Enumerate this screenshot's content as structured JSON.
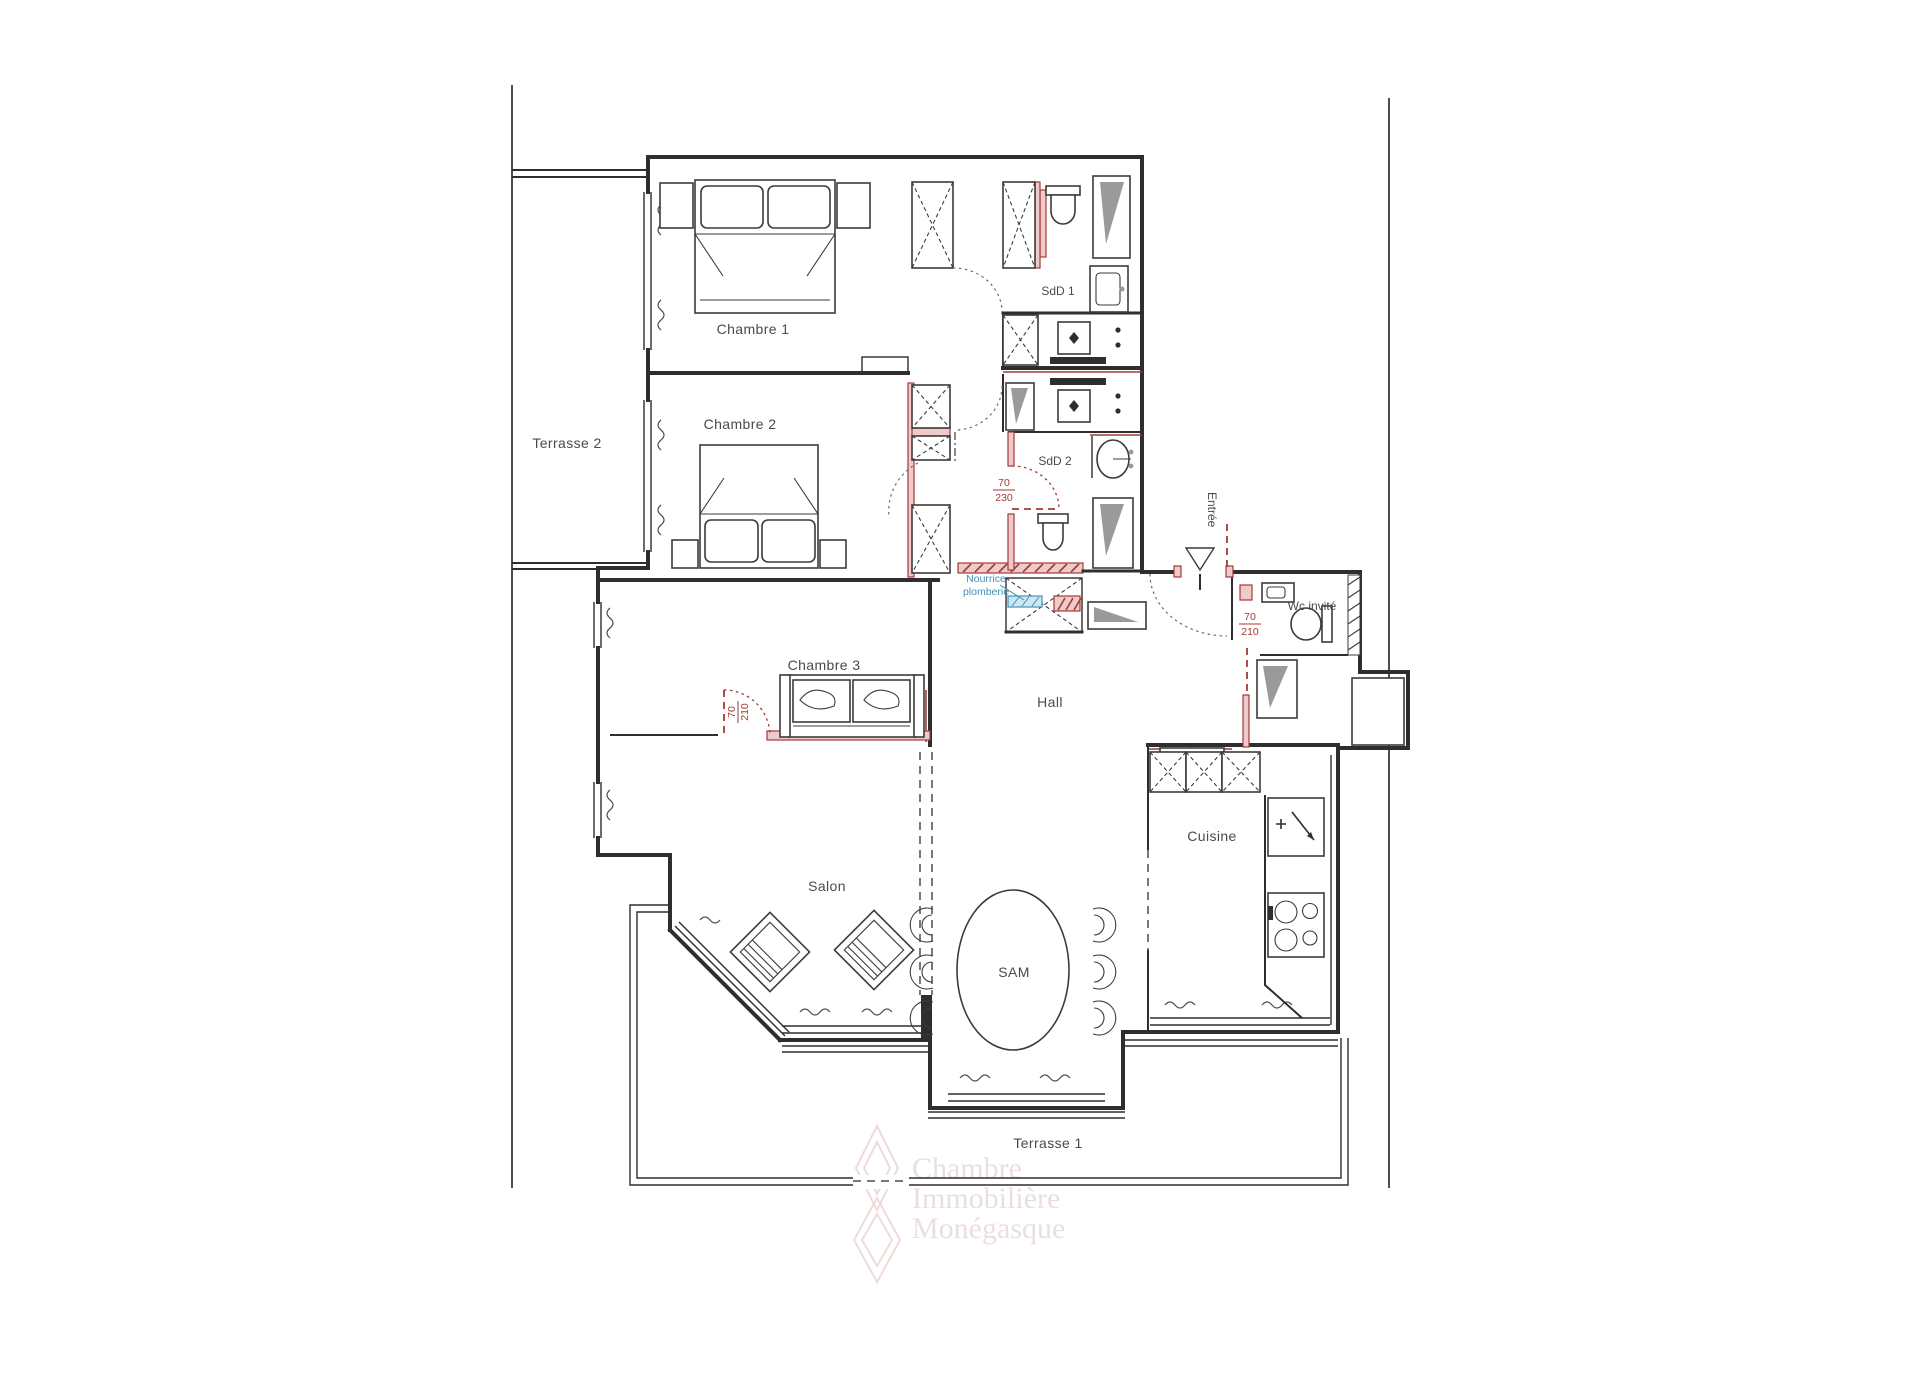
{
  "plan": {
    "rooms": {
      "terrasse2": "Terrasse 2",
      "chambre1": "Chambre 1",
      "chambre2": "Chambre 2",
      "chambre3": "Chambre 3",
      "salon": "Salon",
      "hall": "Hall",
      "sam": "SAM",
      "cuisine": "Cuisine",
      "terrasse1": "Terrasse 1",
      "sdd1": "SdD 1",
      "sdd2": "SdD 2",
      "wc_invite": "Wc invité"
    },
    "annotations": {
      "entree": "Entrée",
      "nourrice_line1": "Nourrice",
      "nourrice_line2": "plomberie",
      "dim_sdd2_num": "70",
      "dim_sdd2_den": "230",
      "dim_wc_num": "70",
      "dim_wc_den": "210",
      "dim_ch3_num": "70",
      "dim_ch3_den": "210"
    },
    "watermark": {
      "line1": "Chambre",
      "line2": "Immobilière",
      "line3": "Monégasque"
    },
    "colors": {
      "wall": "#2e2e2e",
      "red": "#a23a36",
      "red_fill": "#eecaca",
      "blue": "#4191b5",
      "blue_fill": "#cfe7f2",
      "gray": "#9a9a9a",
      "label": "#4a4a4a",
      "watermark_pink": "#ecd2d2",
      "watermark_text": "#d9c4c4"
    }
  }
}
